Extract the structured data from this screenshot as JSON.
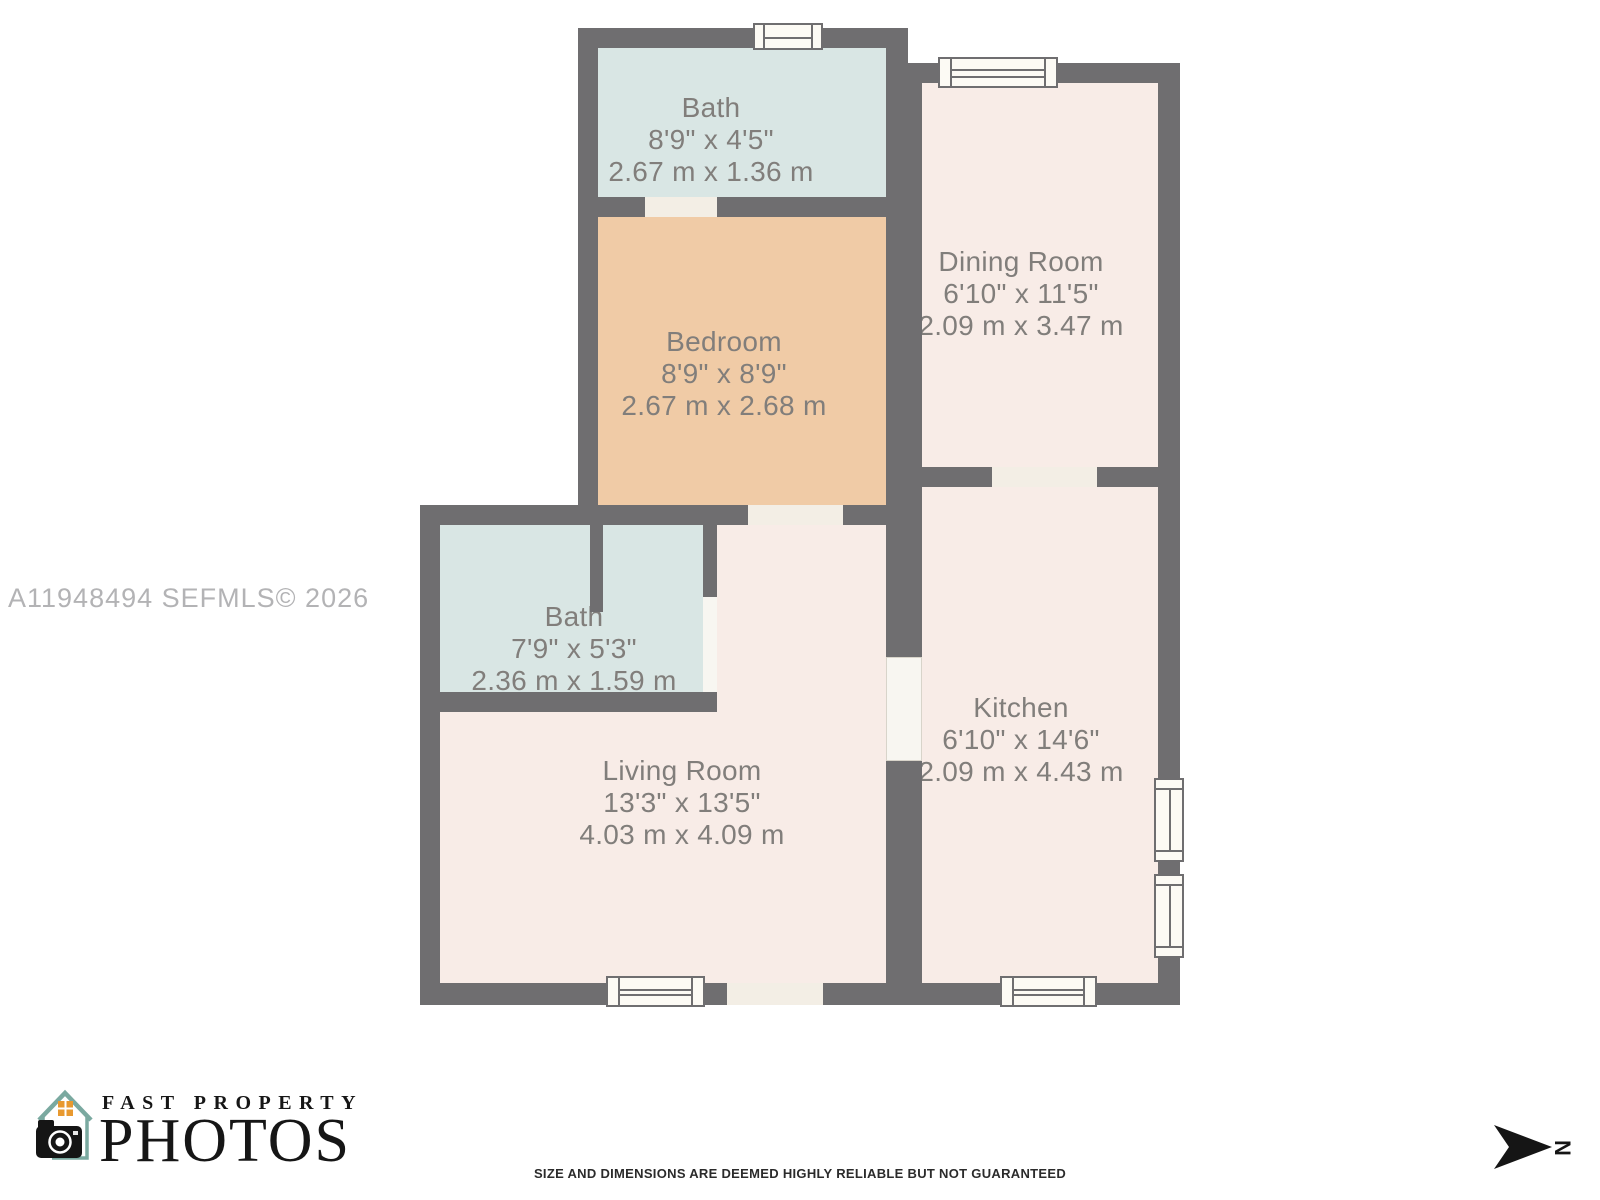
{
  "watermark": "A11948494  SEFMLS© 2026",
  "floorplan": {
    "rooms": [
      {
        "name": "Bath",
        "dims_ft": "8'9\" x 4'5\"",
        "dims_m": "2.67 m x 1.36 m"
      },
      {
        "name": "Bedroom",
        "dims_ft": "8'9\" x 8'9\"",
        "dims_m": "2.67 m x 2.68 m"
      },
      {
        "name": "Dining Room",
        "dims_ft": "6'10\" x 11'5\"",
        "dims_m": "2.09 m x 3.47 m"
      },
      {
        "name": "Bath",
        "dims_ft": "7'9\" x 5'3\"",
        "dims_m": "2.36 m x 1.59 m"
      },
      {
        "name": "Living Room",
        "dims_ft": "13'3\" x 13'5\"",
        "dims_m": "4.03 m x 4.09 m"
      },
      {
        "name": "Kitchen",
        "dims_ft": "6'10\" x 14'6\"",
        "dims_m": "2.09 m x 4.43 m"
      }
    ],
    "colors": {
      "wall": "#6f6e70",
      "bath_fill": "#d9e6e4",
      "bedroom_fill": "#f0cba6",
      "room_fill": "#f8ece7",
      "opening_fill": "#f3eee5",
      "label_text": "#817e7b"
    }
  },
  "branding": {
    "logo_line1": "FAST PROPERTY",
    "logo_line2": "PHOTOS",
    "teal": "#7aa9a0",
    "orange": "#e8992f"
  },
  "compass": {
    "label": "N"
  },
  "disclaimer": "SIZE AND DIMENSIONS ARE DEEMED HIGHLY RELIABLE BUT NOT GUARANTEED"
}
